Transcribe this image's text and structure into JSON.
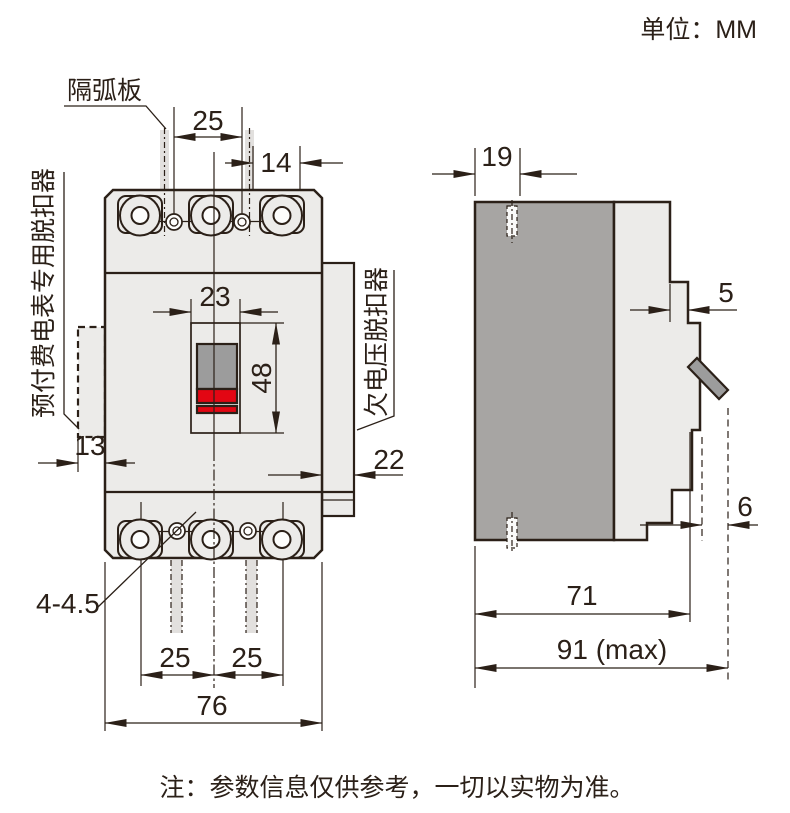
{
  "title": {
    "unit_label": "单位：MM"
  },
  "note": "注：参数信息仅供参考，一切以实物为准。",
  "component_labels": {
    "arc_plate": "隔弧板",
    "prepaid_meter_release": "预付费电表专用脱扣器",
    "undervoltage_release": "欠电压脱扣器",
    "mounting_holes": "4-4.5"
  },
  "front_view": {
    "dim_pole_pitch_top": "25",
    "dim_terminal_offset": "14",
    "dim_handle_window_width": "23",
    "dim_handle_window_height": "48",
    "dim_left_module_depth": "13",
    "dim_right_module_width": "22",
    "dim_pole_pitch_bottom_left": "25",
    "dim_pole_pitch_bottom_right": "25",
    "dim_overall_width": "76"
  },
  "side_view": {
    "dim_top_slot": "19",
    "dim_escutcheon_step": "5",
    "dim_handle_protrusion": "6",
    "dim_depth": "71",
    "dim_depth_max": "91 (max)"
  },
  "colors": {
    "line": "#2b2018",
    "body": "#ecebe9",
    "dark_panel": "#a7a5a3",
    "handle_gray": "#9c9c9c",
    "handle_red": "#e30613",
    "strip": "#e2e0de"
  }
}
